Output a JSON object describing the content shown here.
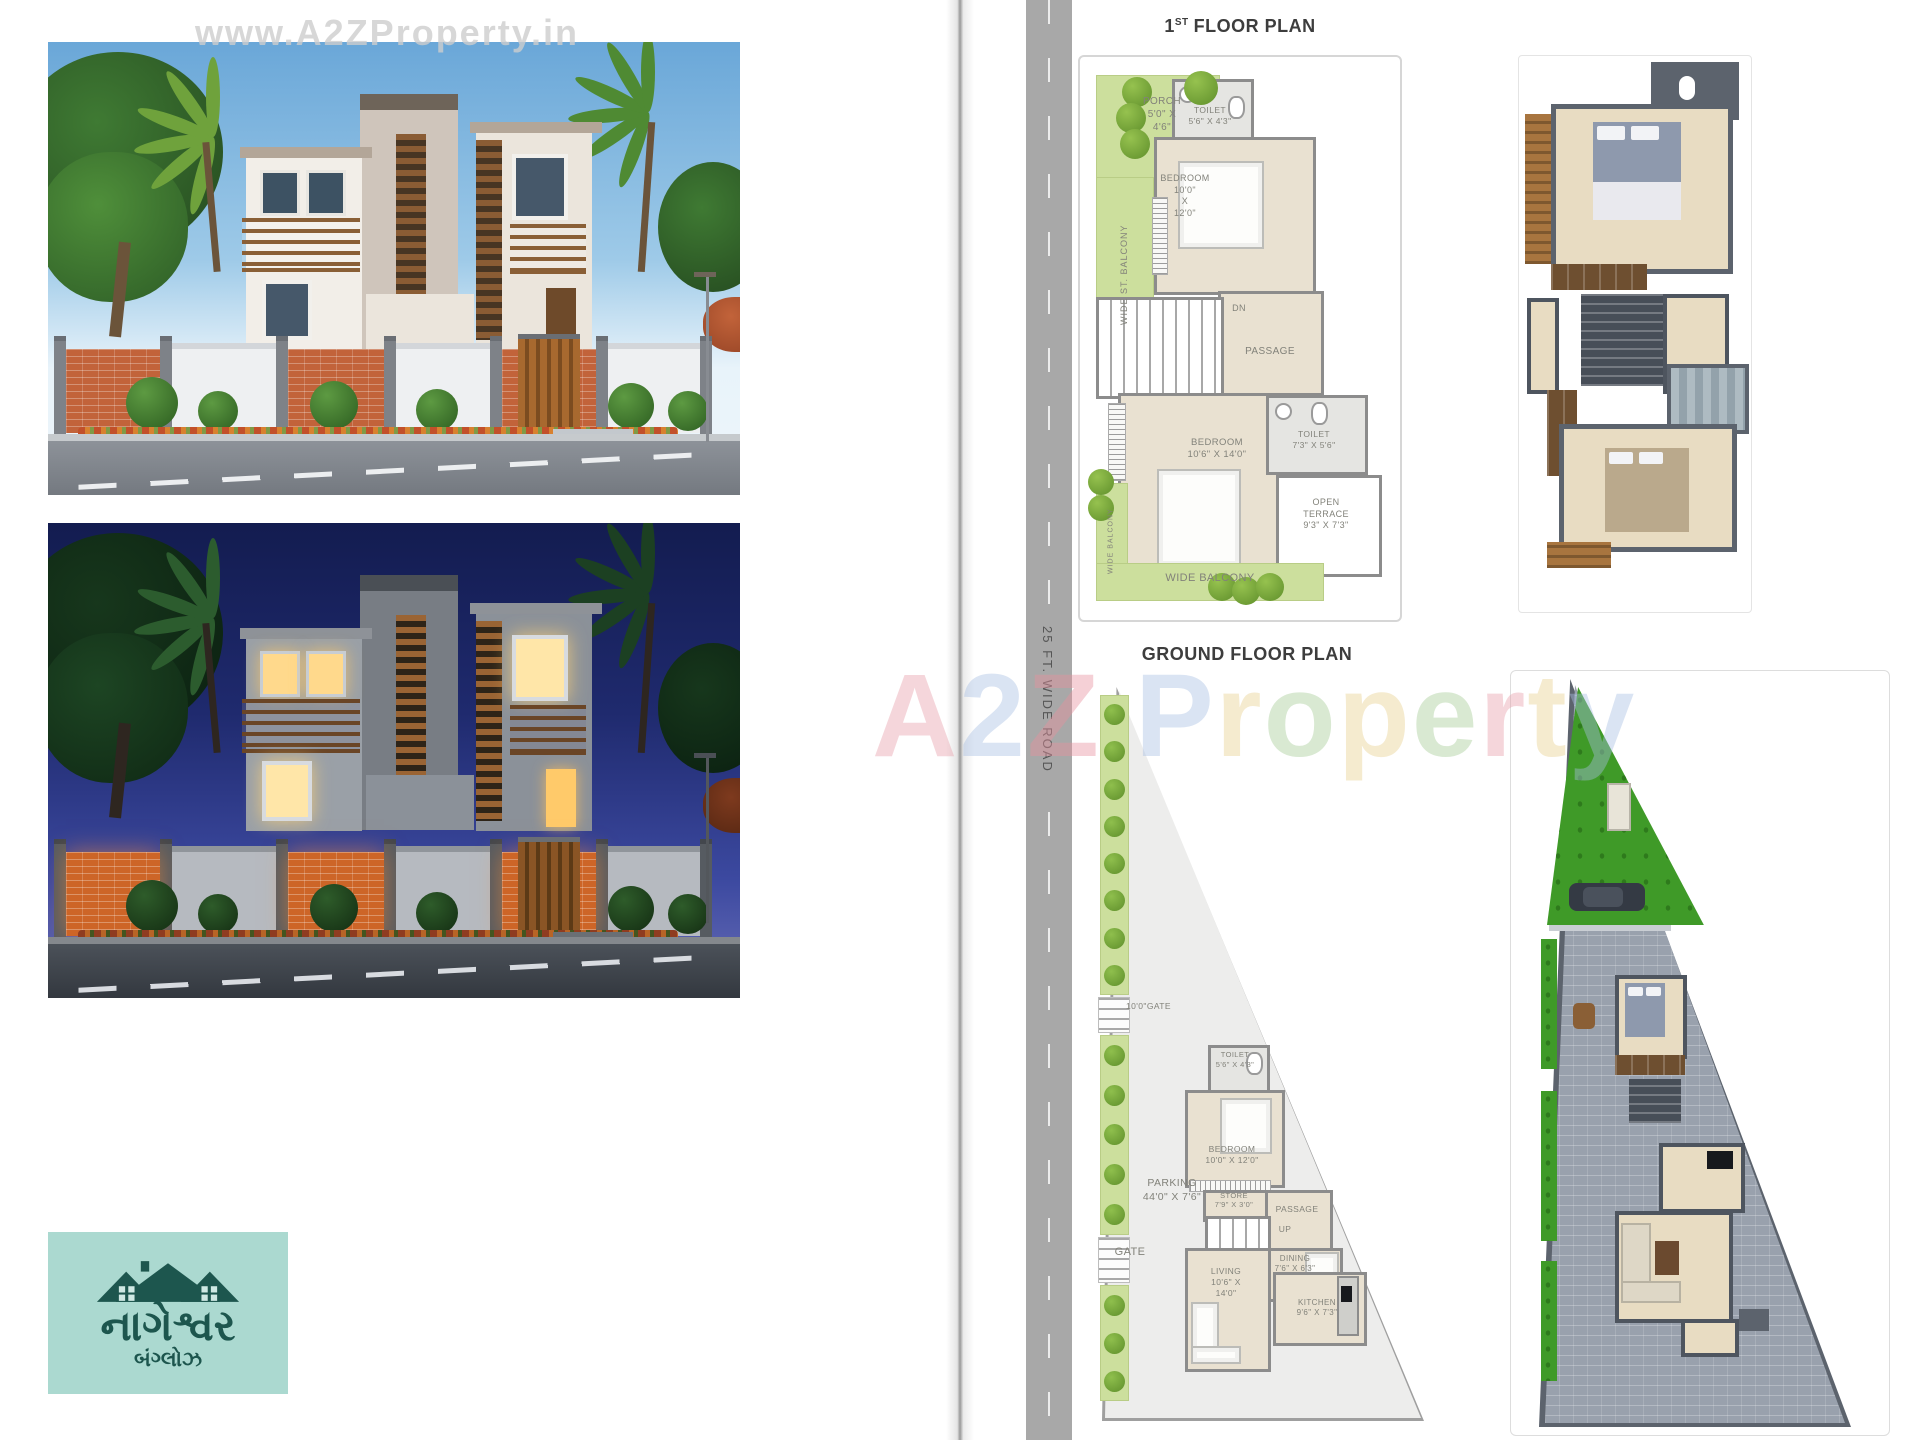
{
  "watermarks": {
    "top": "www.A2ZProperty.in",
    "center": [
      {
        "ch": "A",
        "color": "#e8a0ab"
      },
      {
        "ch": "2",
        "color": "#a8bfe3"
      },
      {
        "ch": "Z",
        "color": "#e8919e"
      },
      {
        "ch": " ",
        "color": "#ffffff"
      },
      {
        "ch": "P",
        "color": "#a8bfe3"
      },
      {
        "ch": "r",
        "color": "#e8d08e"
      },
      {
        "ch": "o",
        "color": "#a5cc96"
      },
      {
        "ch": "p",
        "color": "#e8d08e"
      },
      {
        "ch": "e",
        "color": "#a5cc96"
      },
      {
        "ch": "r",
        "color": "#e8a0ab"
      },
      {
        "ch": "t",
        "color": "#e8d08e"
      },
      {
        "ch": "y",
        "color": "#a8bfe3"
      }
    ]
  },
  "road": {
    "label": "25 FT. WIDE ROAD"
  },
  "first_floor": {
    "title_num": "1",
    "title_sup": "ST",
    "title_rest": "FLOOR PLAN",
    "porch": {
      "name": "PORCH",
      "dim1": "5'0\" X",
      "dim2": "4'6\""
    },
    "st_balcony": {
      "label": "WIDE ST. BALCONY"
    },
    "toilet1": {
      "name": "TOILET",
      "dim": "5'6\" X 4'3\""
    },
    "bedroom1": {
      "name": "BEDROOM",
      "dim1": "10'0\"",
      "dim2": "X",
      "dim3": "12'0\""
    },
    "dn": {
      "label": "DN"
    },
    "passage": {
      "label": "PASSAGE"
    },
    "bedroom2": {
      "name": "BEDROOM",
      "dim": "10'6\" X 14'0\""
    },
    "toilet2": {
      "name": "TOILET",
      "dim": "7'3\" X 5'6\""
    },
    "terrace": {
      "name1": "OPEN",
      "name2": "TERRACE",
      "dim": "9'3\" X 7'3\""
    },
    "balcony_left": {
      "label": "WIDE BALCONY"
    },
    "balcony_bottom": {
      "label": "WIDE BALCONY"
    }
  },
  "ground_floor": {
    "title": "GROUND FLOOR PLAN",
    "gate_top": {
      "label": "10'0\"GATE"
    },
    "parking": {
      "name": "PARKING",
      "dim": "44'0\" X 7'6\""
    },
    "gate": {
      "label": "GATE"
    },
    "toilet": {
      "name": "TOILET",
      "dim": "5'6\" X 4'3\""
    },
    "bedroom": {
      "name": "BEDROOM",
      "dim": "10'0\" X 12'0\""
    },
    "store": {
      "name": "STORE",
      "dim": "7'9\" X 3'0\""
    },
    "passage": {
      "label": "PASSAGE"
    },
    "up": {
      "label": "UP"
    },
    "dining": {
      "name": "DINING",
      "dim": "7'6\" X 6'3\""
    },
    "living": {
      "name": "LIVING",
      "dim1": "10'6\" X",
      "dim2": "14'0\""
    },
    "kitchen": {
      "name": "KITCHEN",
      "dim": "9'6\" X 7'3\""
    }
  },
  "logo": {
    "title": "નાગેશ્વર",
    "subtitle": "બંગ્લોઝ"
  },
  "colors": {
    "plan_green": "#ccdf9d",
    "plan_wall": "#8c8c8c",
    "plan_floor": "#e9e1d1",
    "logo_teal": "#1d564e",
    "logo_bg": "#abd9d0",
    "road_gray": "#a8a8a8"
  }
}
